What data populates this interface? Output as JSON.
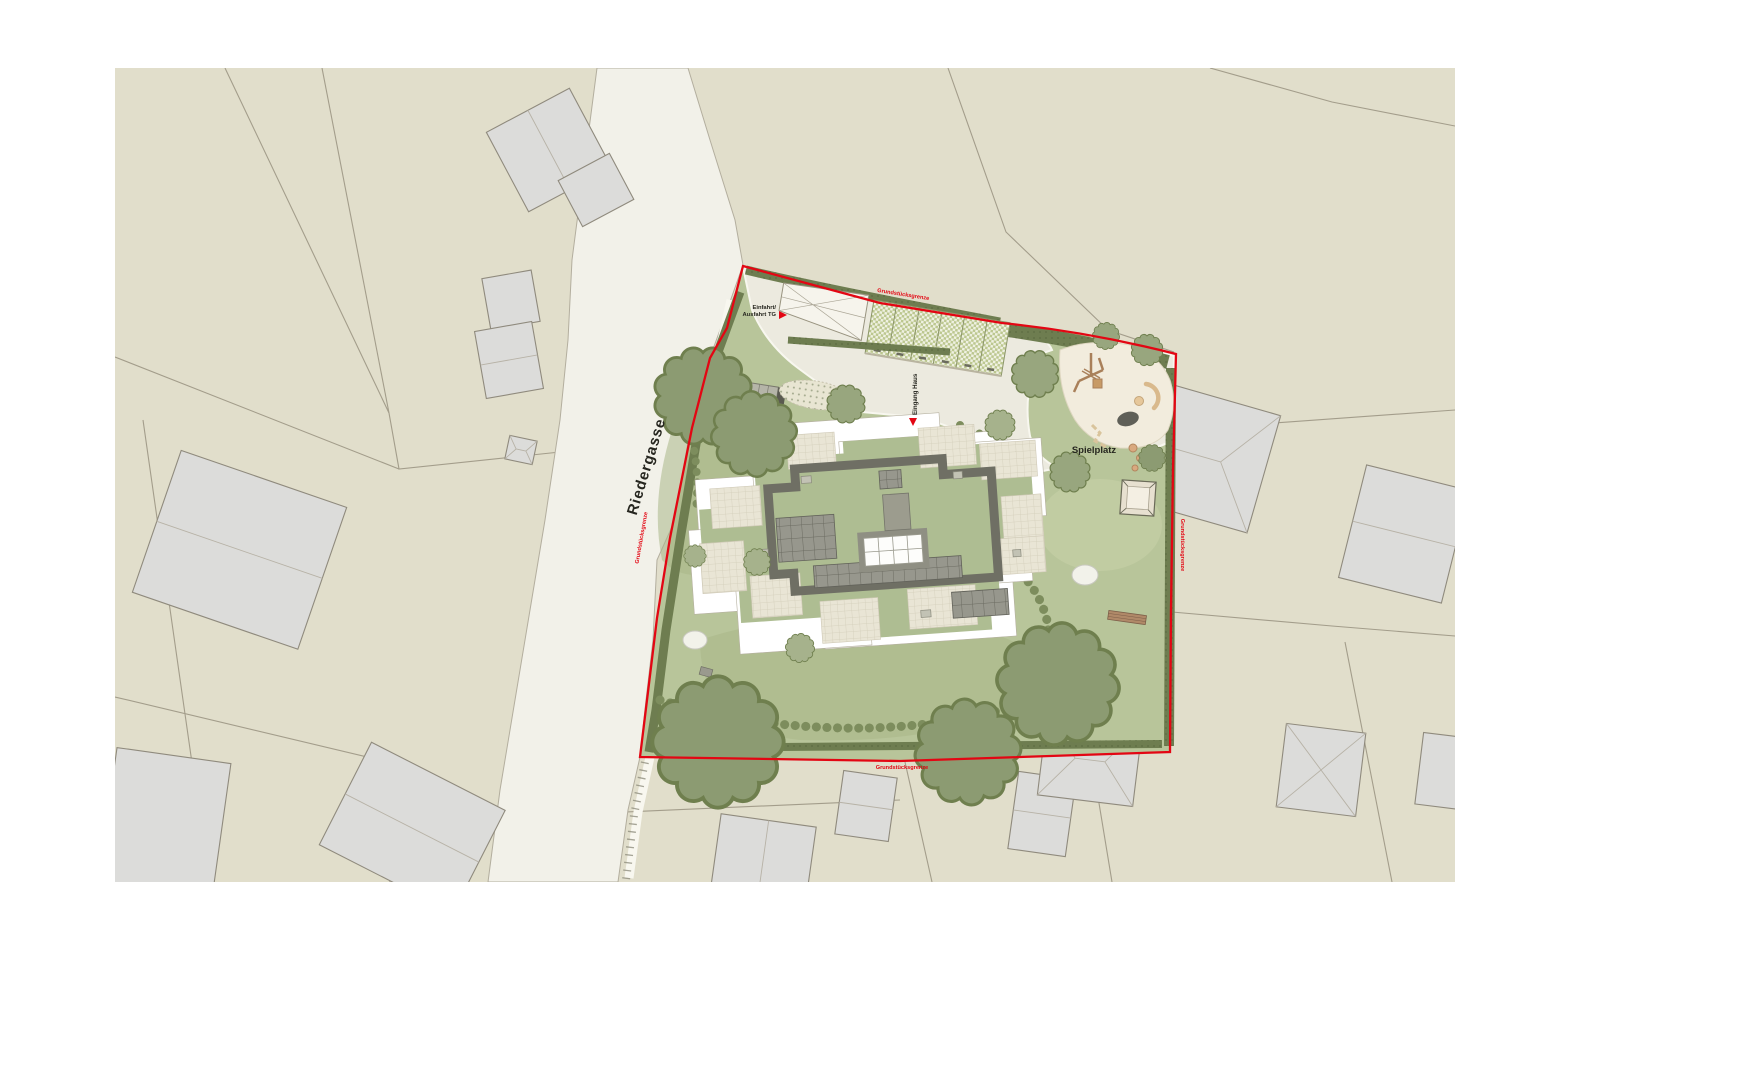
{
  "labels": {
    "street": "Riedergasse",
    "boundary": "Grundstücksgrenze",
    "garage_entry_line1": "Einfahrt/",
    "garage_entry_line2": "Ausfahrt TG",
    "house_entrance": "Eingang Haus",
    "playground": "Spielplatz"
  },
  "colors": {
    "page": "#ffffff",
    "map_bg": "#e1decb",
    "parcel_line": "#a39d8b",
    "street": "#f2f1e9",
    "neighbor_building": "#dcdcda",
    "neighbor_outline": "#8f8a7d",
    "boundary_red": "#e30613",
    "lawn": "#b8c59a",
    "lawn_shade": "#a9b789",
    "pavement": "#eceadf",
    "hedge": "#6e7d50",
    "shrub_row": "#7d8d5d",
    "tree": "#98a67e",
    "tree_dark": "#8c9b72",
    "tree_light": "#a6b28c",
    "building_white": "#ffffff",
    "green_roof": "#aebd92",
    "tile": "#e9e5d5",
    "roof_ring": "#6f6f64",
    "solar": "#97978d",
    "sand": "#f2ecdd",
    "wood": "#a9805a",
    "bench": "#b08968",
    "boulder": "#5f5f57",
    "label_dark": "#26261f"
  }
}
